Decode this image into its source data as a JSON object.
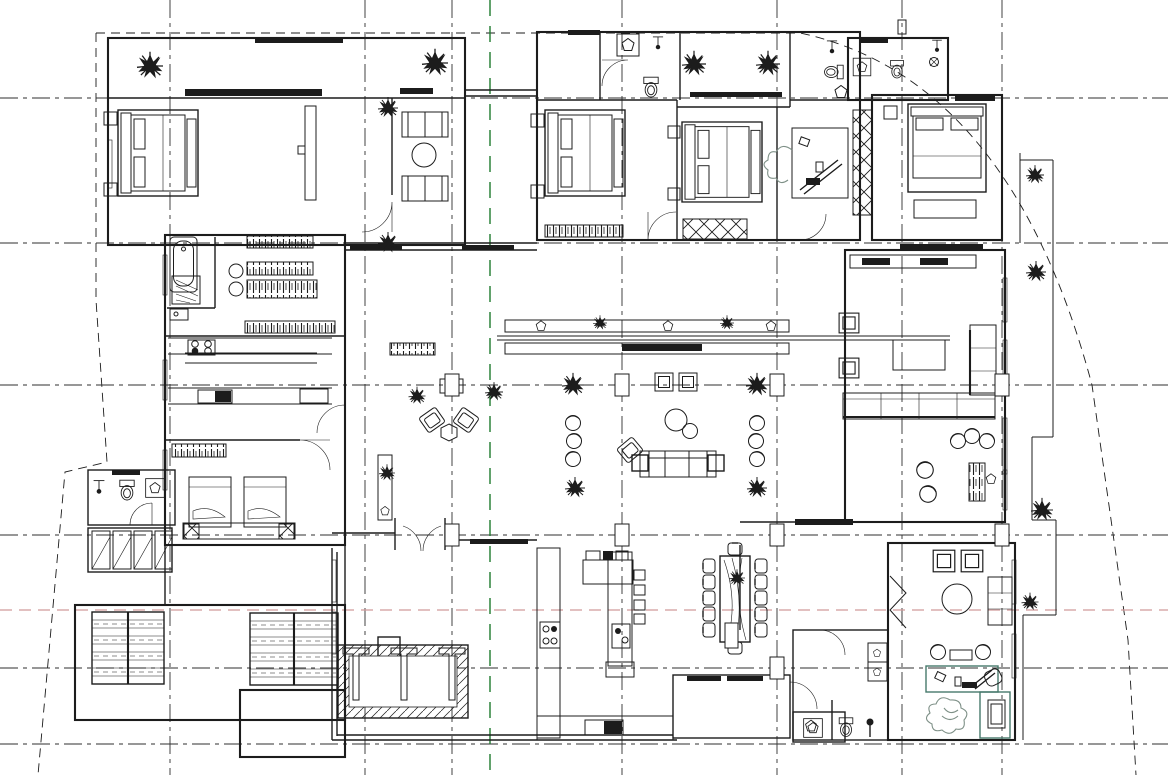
{
  "document": {
    "kind": "Architectural floor plan (CAD line drawing, no text labels)",
    "canvas": {
      "width": 1168,
      "height": 775
    }
  },
  "palette": {
    "background": "#ffffff",
    "ink": "#1c1c1c",
    "axis_line": "#2f2f2f",
    "green_axis": "#1e7b2e",
    "red_axis": "#d09a9a",
    "desk_accent": "#46796b",
    "chair_sketch": "#7e9087"
  },
  "grid": {
    "horizontal_axes_y": [
      98,
      243,
      385,
      535,
      668,
      744
    ],
    "vertical_axes_x": [
      170,
      365,
      452,
      622,
      777,
      902,
      1002
    ],
    "green_axis_x": 490,
    "red_axis_y": 610,
    "axis_dash": "18 5 4 5",
    "green_dash": "16 10",
    "red_dash": "12 7",
    "boundary_dash": "9 6"
  },
  "site_boundary": {
    "paths": [
      "M96,33 H800 Q1010,78 1092,385 L1128,640 L1136,775",
      "M96,33 V300 L107,462 L65,472 L38,775"
    ]
  },
  "rooms": [
    {
      "name": "bedroom-1-northwest"
    },
    {
      "name": "sitting-alcove-with-sofas"
    },
    {
      "name": "bathroom-with-tub"
    },
    {
      "name": "walk-in-closet"
    },
    {
      "name": "kitchen-west"
    },
    {
      "name": "twin-bedroom"
    },
    {
      "name": "bathroom-southwest"
    },
    {
      "name": "storage-room"
    },
    {
      "name": "staircase-west"
    },
    {
      "name": "staircase-east"
    },
    {
      "name": "bedroom-2-center"
    },
    {
      "name": "bedroom-3-center"
    },
    {
      "name": "bathroom-center-north"
    },
    {
      "name": "north-terrace-with-plants"
    },
    {
      "name": "bathroom-northeast-1"
    },
    {
      "name": "bathroom-northeast-2"
    },
    {
      "name": "study-with-desk"
    },
    {
      "name": "bedroom-4-northeast"
    },
    {
      "name": "central-great-hall"
    },
    {
      "name": "living-room-east"
    },
    {
      "name": "kitchen-south-with-island"
    },
    {
      "name": "dining-area"
    },
    {
      "name": "family-study-southeast"
    },
    {
      "name": "bathroom-southeast"
    },
    {
      "name": "south-terrace"
    },
    {
      "name": "sunken-court-with-pergola"
    }
  ],
  "symbols": {
    "plant": "spiky-shrub-icon",
    "toilet": "toilet-icon",
    "washbasin": "pentagon-basin-icon",
    "bathtub": "bathtub-icon",
    "double_bed": "double-bed-icon",
    "single_bed": "single-bed-icon",
    "sofa": "sofa-icon",
    "armchair": "armchair-icon",
    "dining_table": "dining-table-icon",
    "bar_stool": "bar-stool-icon",
    "column": "structural-column-icon",
    "stairs": "stairs-icon",
    "wardrobe": "hatched-wardrobe-icon"
  }
}
